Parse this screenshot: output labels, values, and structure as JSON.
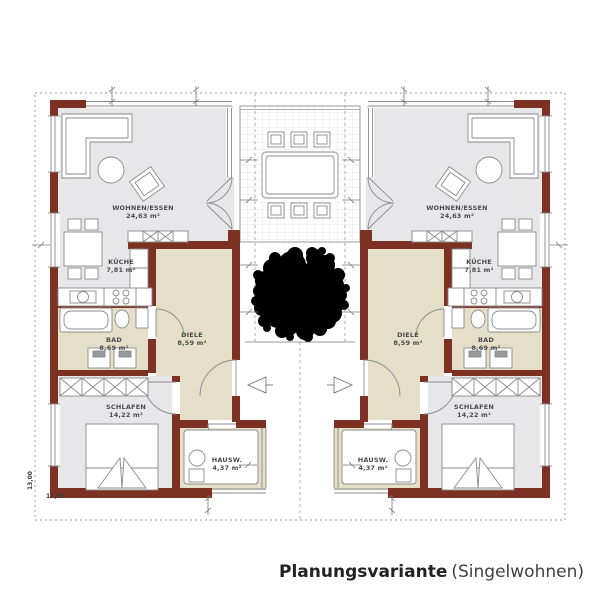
{
  "caption": {
    "title": "Planungsvariante",
    "subtitle": "(Singelwohnen)"
  },
  "rooms": {
    "wohnen_essen": {
      "name": "WOHNEN/ESSEN",
      "area": "24,63 m²"
    },
    "kueche": {
      "name": "KÜCHE",
      "area": "7,81 m²"
    },
    "bad": {
      "name": "BAD",
      "area": "8,69 m²"
    },
    "diele": {
      "name": "DIELE",
      "area": "8,59 m²"
    },
    "schlafen": {
      "name": "SCHLAFEN",
      "area": "14,22 m²"
    },
    "hausw": {
      "name": "HAUSW.",
      "area": "4,37 m²"
    }
  },
  "dimensions": {
    "total_width": "17,99",
    "total_height": "13,00"
  },
  "icons": {
    "tree": "tree-symbol",
    "entry_arrow": "entry-arrow"
  },
  "colors": {
    "wall": "#7d3123",
    "room_gray": "#e7e7e9",
    "room_beige": "#e5dfc9",
    "line": "#8a8a8a",
    "caption_text": "#2f2f2f"
  }
}
